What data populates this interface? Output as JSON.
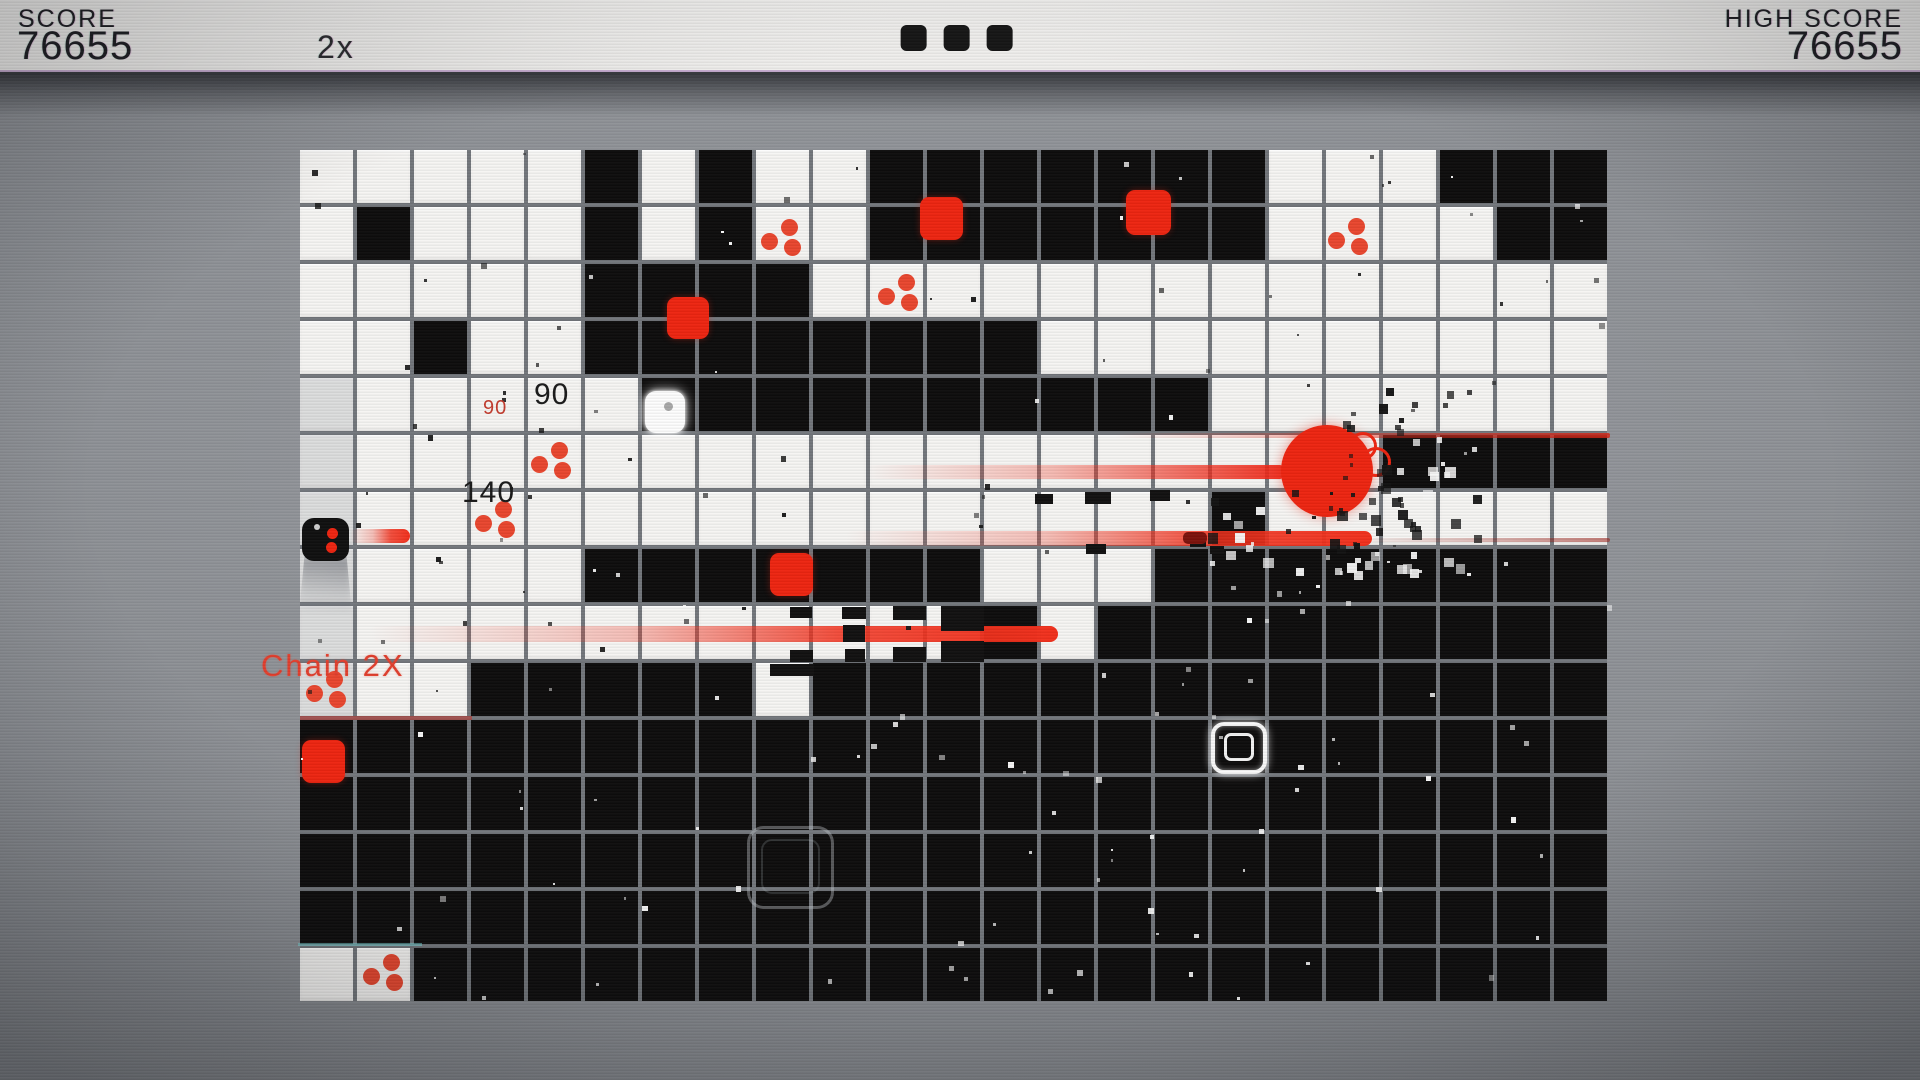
{
  "hud": {
    "score_label": "SCORE",
    "score_value": "76655",
    "high_score_label": "HIGH SCORE",
    "high_score_value": "76655",
    "multiplier": "2x",
    "lives_count": 3
  },
  "colors": {
    "red": "#ee2511",
    "cell_white": "#f6f5f3",
    "cell_black": "#0e0d0d",
    "board_line_gray": "#73777c",
    "background_gray": "#8b8e93",
    "hud_bg": "#f4f3f1",
    "hud_text": "#1d1d22",
    "chain_red": "#e2402e"
  },
  "board": {
    "x": 300,
    "y": 150,
    "cols": 23,
    "rows": 15,
    "cell": 53,
    "gap": 4,
    "pattern": [
      "WWWWWBWBWWBBBBBBBWWWBBB",
      "WBWWWBWBWWBBBBBBBWWWWBB",
      "WWWWWBBBBWWWWWWWWWWWWWW",
      "WWBWWBBBBBBBBWWWWWWWWWW",
      "WWWWWWBBBBBBBBBBWWWWWWW",
      "WWWWWWWWWWWWWWWWWWWBBBB",
      "WWWWWWWWWWWWWWWWBWWWWWW",
      "WWWWWBBBBBBBWWWBBBBBBBB",
      "WWWWWWWWWWWWBWBBBBBBBBB",
      "WWWBBBBBWBBBBBBBBBBBBBB",
      "BBBBBBBBBBBBBBBBBBBBBBB",
      "BBBBBBBBBBBBBBBBBBBBBBB",
      "BBBBBBBBBBBBBBBBBBBBBBB",
      "BBBBBBBBBBBBBBBBBBBBBBB",
      "WWBBBBBBBBBBBBBBBBBBBBB"
    ]
  },
  "entities": {
    "player_black": {
      "x": 302,
      "y": 518,
      "w": 47,
      "h": 43,
      "white_dot": [
        12,
        6,
        6
      ],
      "red_dots": [
        [
          25,
          10,
          11
        ],
        [
          24,
          24,
          11
        ]
      ]
    },
    "player_white": {
      "x": 645,
      "y": 391,
      "w": 40,
      "h": 42,
      "gray_dot": [
        19,
        11,
        9
      ]
    },
    "enemies": [
      {
        "x": 920,
        "y": 197,
        "s": 43
      },
      {
        "x": 1126,
        "y": 190,
        "s": 45
      },
      {
        "x": 667,
        "y": 297,
        "s": 42
      },
      {
        "x": 770,
        "y": 553,
        "s": 43
      },
      {
        "x": 302,
        "y": 740,
        "s": 43
      }
    ],
    "pickups": [
      {
        "x": 783,
        "y": 237
      },
      {
        "x": 900,
        "y": 292
      },
      {
        "x": 1350,
        "y": 236
      },
      {
        "x": 553,
        "y": 460
      },
      {
        "x": 497,
        "y": 519
      },
      {
        "x": 328,
        "y": 689
      },
      {
        "x": 385,
        "y": 972
      }
    ],
    "big_circle": {
      "cx": 1327,
      "cy": 471,
      "r": 46
    },
    "rings": [
      {
        "cx": 1360,
        "cy": 443,
        "r": 11
      },
      {
        "cx": 1373,
        "cy": 459,
        "r": 12
      }
    ],
    "trails": [
      {
        "x": 350,
        "y": 529,
        "w": 60,
        "h": 14,
        "type": "cap"
      },
      {
        "x": 865,
        "y": 465,
        "w": 418,
        "h": 14,
        "type": "fade"
      },
      {
        "x": 845,
        "y": 531,
        "w": 527,
        "h": 15,
        "type": "cap"
      },
      {
        "x": 368,
        "y": 626,
        "w": 690,
        "h": 16,
        "type": "cap"
      },
      {
        "x": 1115,
        "y": 433,
        "w": 495,
        "h": 5,
        "type": "thin"
      },
      {
        "x": 1372,
        "y": 538,
        "w": 238,
        "h": 4,
        "type": "dark"
      }
    ],
    "dark_chunk": {
      "x": 1183,
      "y": 532,
      "w": 24,
      "h": 12
    },
    "reticles": [
      {
        "x": 1211,
        "y": 722,
        "w": 56,
        "h": 52,
        "style": "bright"
      },
      {
        "x": 747,
        "y": 826,
        "w": 87,
        "h": 83,
        "style": "faint"
      }
    ],
    "fragments": [
      [
        790,
        607,
        22,
        11
      ],
      [
        790,
        650,
        23,
        12
      ],
      [
        842,
        607,
        24,
        12
      ],
      [
        843,
        625,
        22,
        17
      ],
      [
        845,
        649,
        20,
        13
      ],
      [
        893,
        606,
        33,
        14
      ],
      [
        893,
        647,
        33,
        15
      ],
      [
        941,
        606,
        43,
        25
      ],
      [
        941,
        641,
        43,
        21
      ],
      [
        770,
        664,
        44,
        12
      ],
      [
        1035,
        494,
        18,
        10
      ],
      [
        1085,
        492,
        26,
        12
      ],
      [
        1150,
        490,
        20,
        11
      ],
      [
        1086,
        544,
        20,
        10
      ],
      [
        1190,
        538,
        16,
        9
      ],
      [
        1210,
        546,
        14,
        8
      ]
    ],
    "popups": [
      {
        "text": "90",
        "x": 483,
        "y": 398,
        "size": 20,
        "color": "#c43c2e"
      },
      {
        "text": "90",
        "x": 534,
        "y": 380,
        "size": 30,
        "color": "#1a1a1a"
      },
      {
        "text": "140",
        "x": 462,
        "y": 478,
        "size": 30,
        "color": "#1a1a1a"
      }
    ],
    "chain": {
      "text": "Chain 2X",
      "x": 261,
      "y": 650,
      "size": 31
    },
    "edge_glows": [
      {
        "x": 300,
        "y": 716,
        "w": 172,
        "h": 4,
        "color": "rgba(205,45,35,0.5)"
      },
      {
        "x": 298,
        "y": 943,
        "w": 124,
        "h": 3,
        "color": "rgba(120,215,215,0.55)"
      }
    ],
    "zone_overlay": {
      "x": 300,
      "y": 378,
      "w": 54,
      "h": 342,
      "color": "rgba(120,125,135,0.20)"
    }
  },
  "effects": {
    "speckle_seed": 7,
    "speckle_count": 160,
    "clouds": [
      {
        "x": 1330,
        "y": 388,
        "w": 145,
        "h": 185,
        "n": 65
      },
      {
        "x": 1185,
        "y": 482,
        "w": 190,
        "h": 92,
        "n": 22
      }
    ]
  }
}
